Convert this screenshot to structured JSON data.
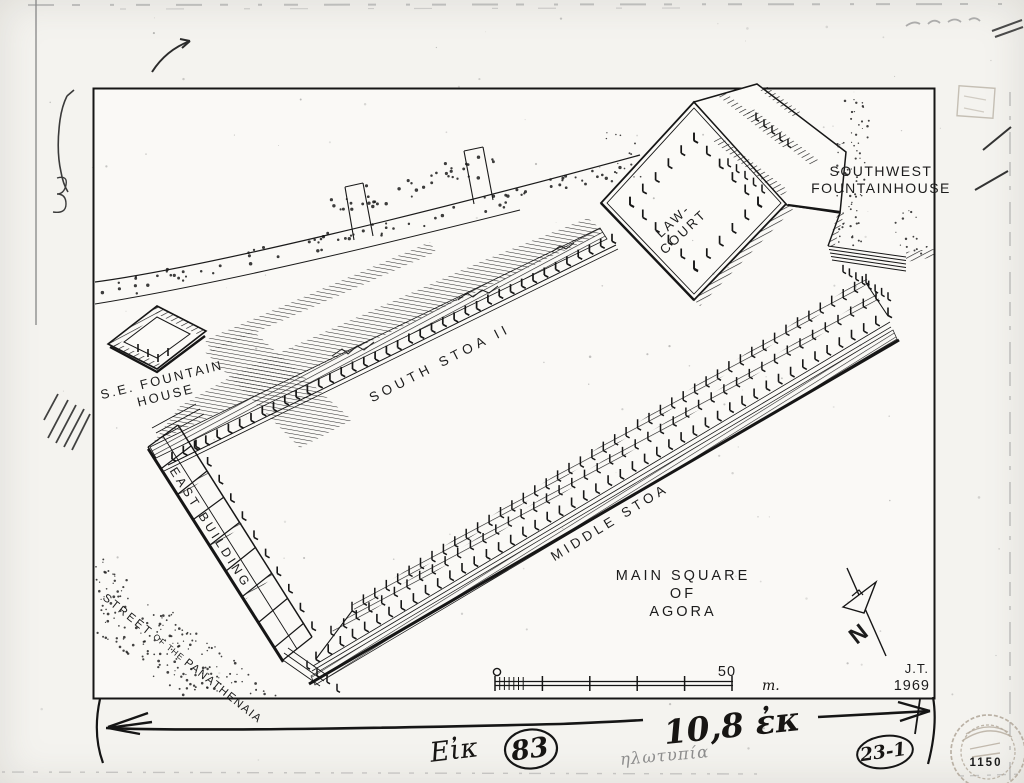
{
  "drawing": {
    "labels": {
      "south_stoa": "SOUTH STOA II",
      "middle_stoa": "MIDDLE STOA",
      "east_building": "EAST BUILDING",
      "se_fountain_house_line1": "S.E. FOUNTAIN",
      "se_fountain_house_line2": "HOUSE",
      "sw_fountainhouse_line1": "SOUTHWEST",
      "sw_fountainhouse_line2": "FOUNTAINHOUSE",
      "law_court_line1": "LAW-",
      "law_court_line2": "COURT",
      "main_square_line1": "MAIN  SQUARE",
      "main_square_line2": "OF",
      "main_square_line3": "AGORA",
      "street_part1": "STREET",
      "street_part2": " OF THE ",
      "street_part3": "PANATHENAIA"
    },
    "scale_bar": {
      "start_value": "0",
      "end_value": "50",
      "unit": "m."
    },
    "north_arrow": {
      "label": "N"
    },
    "signature": {
      "initials": "J.T.",
      "year": "1969"
    }
  },
  "annotations": {
    "figure_abbr": "Εἰκ",
    "figure_number": "83",
    "width_note": "10,8 ἐκ",
    "faint_note": "ηλωτυπία",
    "catalog_number": "23-1",
    "stamp_number": "1150"
  },
  "colors": {
    "ink": "#1c1c1c",
    "paper": "#faf9f5",
    "page": "#f4f3ef",
    "pencil": "#8d8d8d",
    "stamp": "#b4aa9c"
  }
}
